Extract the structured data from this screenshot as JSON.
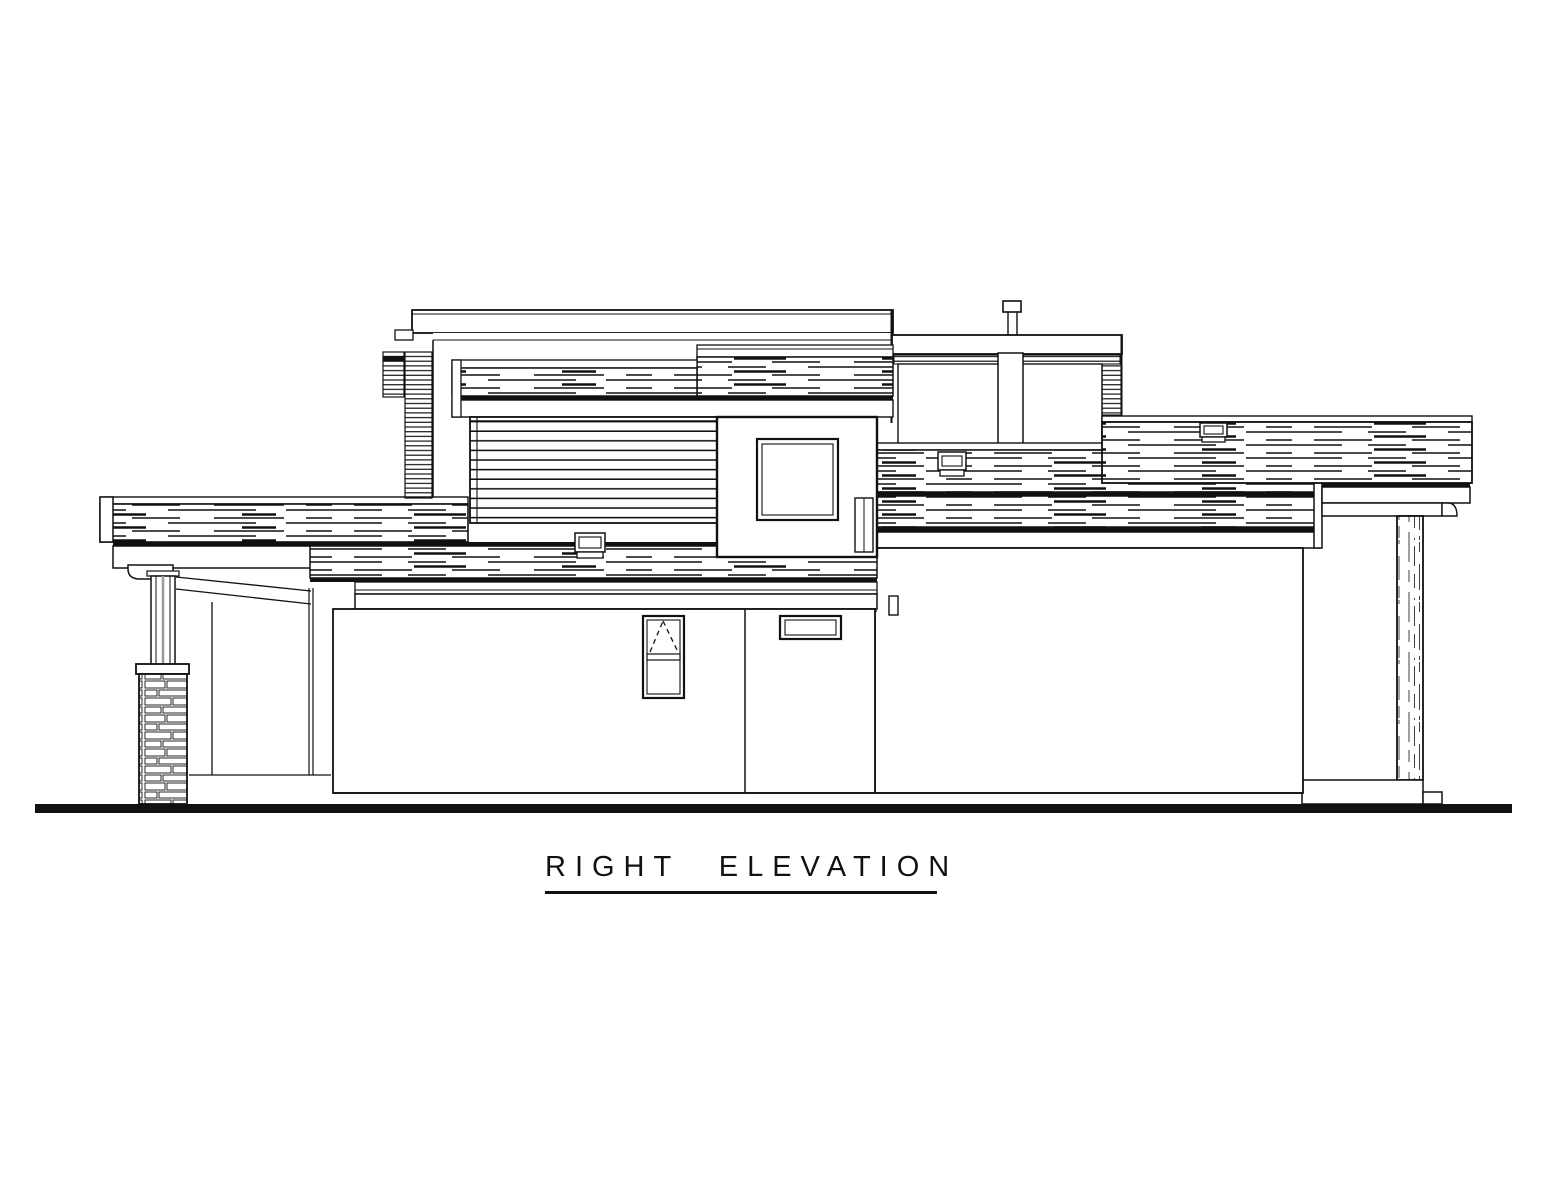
{
  "drawing": {
    "title": "RIGHT ELEVATION",
    "type": "architectural side elevation line drawing",
    "line_color": "#111111",
    "background_color": "#ffffff",
    "components": [
      "second-floor mass with flat parapet roof",
      "wood-grain fascia bands",
      "horizontal siding panel",
      "square fixed window in projecting bay",
      "clerestory band with center post and roof vent pipe",
      "garage wing with long wood-grain fascia",
      "covered patio roof on square wood column",
      "entry porch roof on tapered post with stacked-stone pier",
      "tall awning window with dashed operation symbol",
      "small transom window",
      "three small roof vents",
      "thick ground line"
    ]
  }
}
